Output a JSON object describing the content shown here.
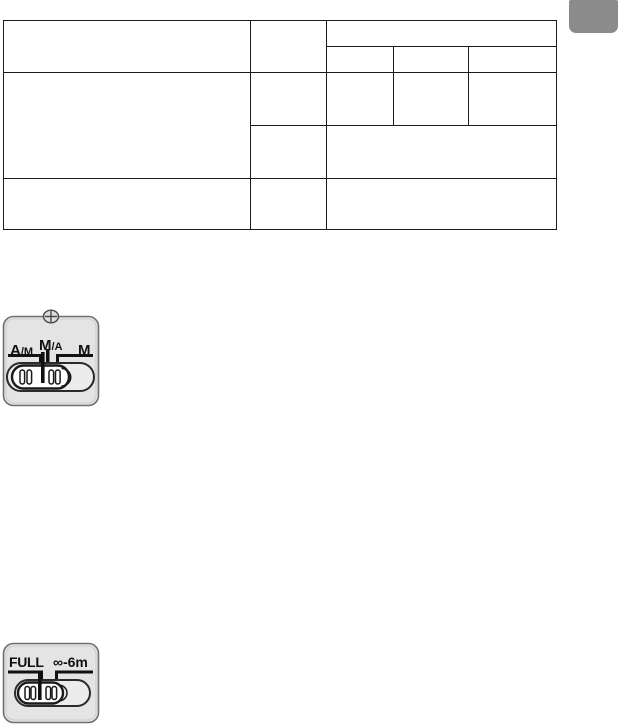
{
  "table": {
    "cells": {
      "r1c1": "",
      "r1c2": "",
      "r1c3_band": "",
      "r2c3a": "",
      "r2c3b": "",
      "r2c3c": "",
      "r3c1": "",
      "r3c2": "",
      "r3c3a": "",
      "r3c3b": "",
      "r3c3c": "",
      "r4c2": "",
      "r4c3": "",
      "r5c1": "",
      "r5c2": "",
      "r5c3": ""
    }
  },
  "focus_mode_switch": {
    "position_labels": {
      "am_main": "A",
      "am_sub": "/M",
      "ma_main": "M",
      "ma_sub": "/A",
      "m": "M"
    }
  },
  "focus_limit_switch": {
    "position_labels": {
      "full": "FULL",
      "range": "∞-6m"
    }
  },
  "colors": {
    "tab_gray": "#8b8b8b",
    "table_line": "#1a1a1a",
    "plate_fill": "#e4e4e4",
    "plate_border": "#6f6f6f",
    "knob_fill": "#ffffff",
    "mark_black": "#111111"
  }
}
